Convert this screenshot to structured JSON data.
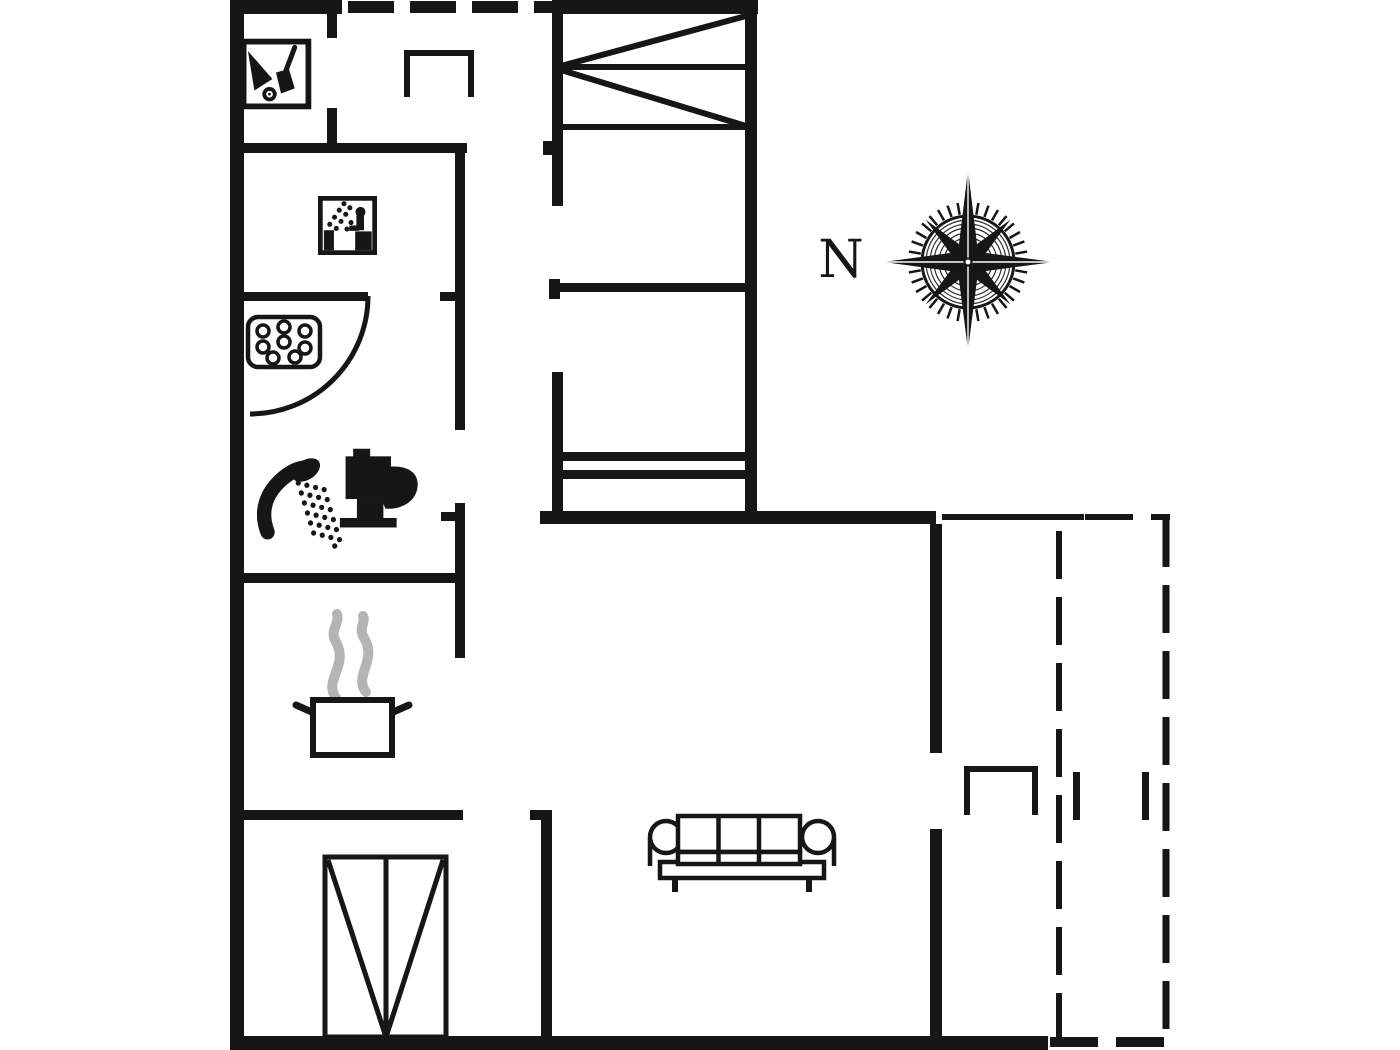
{
  "page": {
    "bg": "#ffffff",
    "ink": "#161616",
    "steam_color": "#b4b4b4"
  },
  "compass": {
    "label": "N",
    "label_x": 841,
    "label_y": 277,
    "label_size": 52
  },
  "floorplan": {
    "width": 1400,
    "height": 1050,
    "walls": [
      {
        "n": "outer-wall-left",
        "r": [
          230,
          0,
          14,
          1050
        ]
      },
      {
        "n": "outer-wall-top-left",
        "r": [
          230,
          0,
          112,
          14
        ]
      },
      {
        "n": "outer-wall-top-right",
        "r": [
          552,
          0,
          206,
          14
        ]
      },
      {
        "n": "bedroom-wing-right-wall",
        "r": [
          745,
          0,
          12,
          524
        ]
      },
      {
        "n": "mid-horizontal-wall",
        "r": [
          540,
          511,
          396,
          13
        ]
      },
      {
        "n": "living-right-wall-upper",
        "r": [
          930,
          524,
          12,
          229
        ]
      },
      {
        "n": "living-right-wall-lower",
        "r": [
          930,
          829,
          12,
          211
        ]
      },
      {
        "n": "outer-wall-bottom",
        "r": [
          230,
          1036,
          818,
          14
        ]
      },
      {
        "n": "utility-door-stub-top",
        "r": [
          327,
          14,
          10,
          24
        ]
      },
      {
        "n": "utility-door-stub-bottom",
        "r": [
          327,
          108,
          10,
          40
        ]
      },
      {
        "n": "utility-sauna-wall",
        "r": [
          230,
          143,
          237,
          10
        ]
      },
      {
        "n": "hall-left-wall-upper",
        "r": [
          455,
          147,
          10,
          283
        ]
      },
      {
        "n": "bath-door-stub",
        "r": [
          440,
          292,
          17,
          9
        ]
      },
      {
        "n": "bath-top-wall",
        "r": [
          230,
          292,
          138,
          9
        ]
      },
      {
        "n": "hall-left-wall-lower",
        "r": [
          455,
          503,
          10,
          155
        ]
      },
      {
        "n": "hall-left-tick",
        "r": [
          441,
          512,
          15,
          9
        ]
      },
      {
        "n": "kitchen-top-wall",
        "r": [
          230,
          573,
          235,
          10
        ]
      },
      {
        "n": "kitchen-bottom-wall",
        "r": [
          230,
          810,
          233,
          10
        ]
      },
      {
        "n": "living-left-tick",
        "r": [
          530,
          810,
          22,
          10
        ]
      },
      {
        "n": "living-left-wall",
        "r": [
          541,
          810,
          11,
          230
        ]
      },
      {
        "n": "wing-left-wall-upper",
        "r": [
          552,
          14,
          11,
          192
        ]
      },
      {
        "n": "wing-left-wall-notch",
        "r": [
          543,
          141,
          9,
          14
        ]
      },
      {
        "n": "wing-left-wall-cap",
        "r": [
          549,
          279,
          11,
          20
        ]
      },
      {
        "n": "wing-left-wall-lower",
        "r": [
          552,
          372,
          11,
          152
        ]
      },
      {
        "n": "bedroom-divider-wall",
        "r": [
          555,
          283,
          202,
          9
        ]
      },
      {
        "n": "double-bed-bar-1",
        "r": [
          558,
          452,
          192,
          9
        ]
      },
      {
        "n": "double-bed-bar-2",
        "r": [
          558,
          470,
          192,
          9
        ]
      },
      {
        "n": "terrace-door-jamb-left",
        "r": [
          1073,
          772,
          7,
          48
        ]
      },
      {
        "n": "terrace-door-jamb-right",
        "r": [
          1142,
          772,
          7,
          48
        ]
      }
    ],
    "lines": [
      {
        "n": "bunk-bed-rail-top",
        "p": [
          560,
          67,
          747,
          67
        ],
        "w": 6
      },
      {
        "n": "bunk-bed-rail-bottom",
        "p": [
          560,
          127,
          747,
          127
        ],
        "w": 6
      },
      {
        "n": "bunk-bed-diagonal-upper",
        "p": [
          746,
          16,
          561,
          66
        ],
        "w": 6
      },
      {
        "n": "bunk-bed-diagonal-lower",
        "p": [
          561,
          70,
          746,
          126
        ],
        "w": 6
      },
      {
        "n": "terrace-wall-thin",
        "p": [
          942,
          517,
          1084,
          517
        ],
        "w": 6
      },
      {
        "n": "wardrobe-center-line",
        "p": [
          386,
          858,
          386,
          1036
        ],
        "w": 5
      },
      {
        "n": "wardrobe-diagonal-left",
        "p": [
          328,
          860,
          385,
          1034
        ],
        "w": 5
      },
      {
        "n": "wardrobe-diagonal-right",
        "p": [
          443,
          860,
          387,
          1034
        ],
        "w": 5
      }
    ],
    "polylines": [
      {
        "n": "hall-cabinet",
        "pts": [
          [
            407,
            97
          ],
          [
            407,
            53
          ],
          [
            471,
            53
          ],
          [
            471,
            97
          ]
        ],
        "w": 6
      },
      {
        "n": "terrace-stove",
        "pts": [
          [
            967,
            815
          ],
          [
            967,
            769
          ],
          [
            1035,
            769
          ],
          [
            1035,
            815
          ]
        ],
        "w": 6
      }
    ],
    "rect_outlines": [
      {
        "n": "wardrobe-box",
        "r": [
          325,
          857,
          121,
          180
        ],
        "w": 5
      }
    ],
    "dashed": [
      {
        "n": "window-top",
        "p": [
          348,
          7,
          552,
          7
        ],
        "w": 12,
        "dash": "46 16"
      },
      {
        "n": "terrace-edge-top",
        "p": [
          1085,
          517,
          1170,
          517
        ],
        "w": 6,
        "dash": "48 18"
      },
      {
        "n": "terrace-edge-right",
        "p": [
          1166,
          519,
          1166,
          1040
        ],
        "w": 7,
        "dash": "48 18"
      },
      {
        "n": "terrace-divider",
        "p": [
          1059,
          531,
          1059,
          1040
        ],
        "w": 6,
        "dash": "48 18"
      },
      {
        "n": "terrace-edge-bottom",
        "p": [
          1050,
          1042,
          1174,
          1042
        ],
        "w": 10,
        "dash": "48 18"
      }
    ],
    "arcs": [
      {
        "n": "bath-door-swing",
        "d": "M368,296 A118,118 0 0 1 250,414",
        "w": 5
      }
    ],
    "icons": [
      {
        "name": "garden-tools-icon",
        "x": 240,
        "y": 38,
        "w": 72,
        "h": 72
      },
      {
        "name": "sauna-icon",
        "x": 318,
        "y": 196,
        "w": 59,
        "h": 59
      },
      {
        "name": "whirlpool-icon",
        "x": 246,
        "y": 314,
        "w": 76,
        "h": 56
      },
      {
        "name": "shower-icon",
        "x": 256,
        "y": 446,
        "w": 96,
        "h": 104
      },
      {
        "name": "toilet-icon",
        "x": 338,
        "y": 444,
        "w": 87,
        "h": 92
      },
      {
        "name": "cooking-pot-icon",
        "x": 290,
        "y": 608,
        "w": 125,
        "h": 154
      },
      {
        "name": "sofa-icon",
        "x": 648,
        "y": 810,
        "w": 188,
        "h": 84
      },
      {
        "name": "compass-rose-icon",
        "x": 880,
        "y": 174,
        "w": 176,
        "h": 176
      }
    ]
  }
}
